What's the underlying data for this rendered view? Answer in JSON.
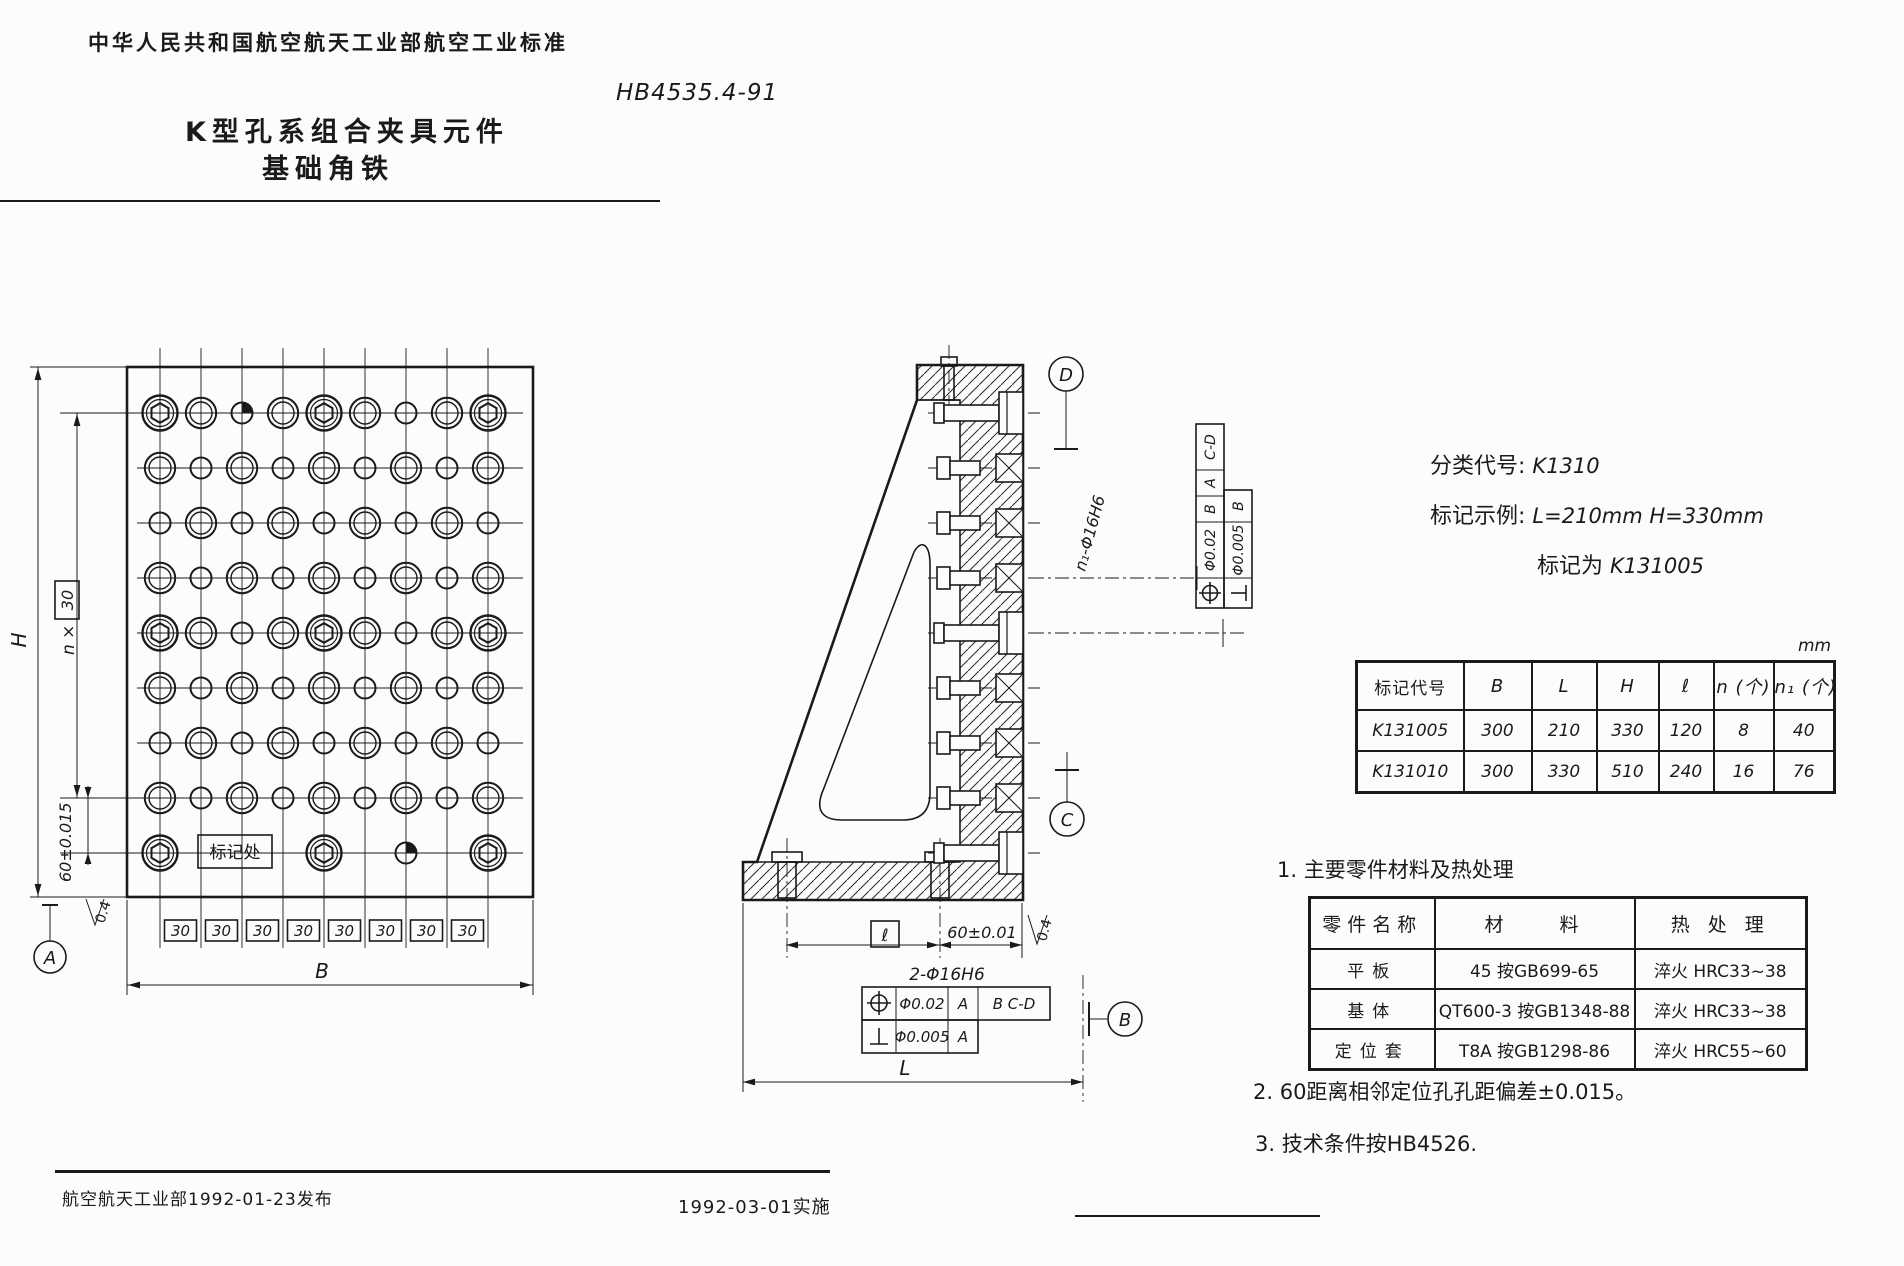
{
  "header": {
    "standard_org_line": "中华人民共和国航空航天工业部航空工业标准",
    "standard_number": "HB4535.4-91",
    "title_line1": "K型孔系组合夹具元件",
    "title_line2": "基础角铁"
  },
  "classification": {
    "class_code_label": "分类代号:",
    "class_code": "K1310",
    "marking_example_label": "标记示例:",
    "marking_example": "L=210mm  H=330mm",
    "marking_label": "标记为",
    "marking_value": "K131005"
  },
  "dim_table": {
    "unit": "mm",
    "headers": [
      "标记代号",
      "B",
      "L",
      "H",
      "ℓ",
      "n (个)",
      "n₁ (个)"
    ],
    "rows": [
      [
        "K131005",
        "300",
        "210",
        "330",
        "120",
        "8",
        "40"
      ],
      [
        "K131010",
        "300",
        "330",
        "510",
        "240",
        "16",
        "76"
      ]
    ]
  },
  "notes": {
    "note1": "1. 主要零件材料及热处理",
    "note2": "2. 60距离相邻定位孔孔距偏差±0.015。",
    "note3": "3. 技术条件按HB4526."
  },
  "material_table": {
    "headers": [
      "零件名称",
      "材　　料",
      "热 处 理"
    ],
    "rows": [
      [
        "平板",
        "45 按GB699-65",
        "淬火 HRC33~38"
      ],
      [
        "基体",
        "QT600-3 按GB1348-88",
        "淬火 HRC33~38"
      ],
      [
        "定位套",
        "T8A 按GB1298-86",
        "淬火 HRC55~60"
      ]
    ]
  },
  "footer": {
    "issued": "航空航天工业部1992-01-23发布",
    "implemented": "1992-03-01实施"
  },
  "front_view": {
    "labels": {
      "H": "H",
      "n_prefix": "n ×",
      "spacing": "30",
      "tol60": "60±0.015",
      "mark": "标记处",
      "datumA": "A",
      "rough": "0.4",
      "B": "B"
    },
    "spacing_boxes": [
      "30",
      "30",
      "30",
      "30",
      "30",
      "30",
      "30",
      "30"
    ],
    "pattern": [
      "XBHBXBSBX",
      "BSBSBSBSB",
      "SBSBSBSBS",
      "BSBSBSBSB",
      "XBSBXBSBX",
      "BSBSBSBSB",
      "SBSBSBSBS",
      "BSBSBSBSB",
      "X---X-H-X"
    ]
  },
  "side_view": {
    "labels": {
      "datumB": "B",
      "datumC": "C",
      "datumD": "D",
      "holes_n1": "n₁-Φ16H6",
      "holes2": "2-Φ16H6",
      "ell": "ℓ",
      "tol60": "60±0.01",
      "L": "L",
      "rough": "0.4"
    },
    "frame_side": {
      "pos_tol": "Φ0.02",
      "pos_d1": "B",
      "pos_d2": "A",
      "pos_d3": "C-D",
      "perp_tol": "Φ0.005",
      "perp_d": "B"
    },
    "frame_bottom": {
      "pos_tol": "Φ0.02",
      "pos_d1": "A",
      "pos_d2": "B  C-D",
      "perp_tol": "Φ0.005",
      "perp_d": "A"
    }
  },
  "colors": {
    "ink": "#1a1a1a",
    "paper": "#fcfcfa"
  }
}
